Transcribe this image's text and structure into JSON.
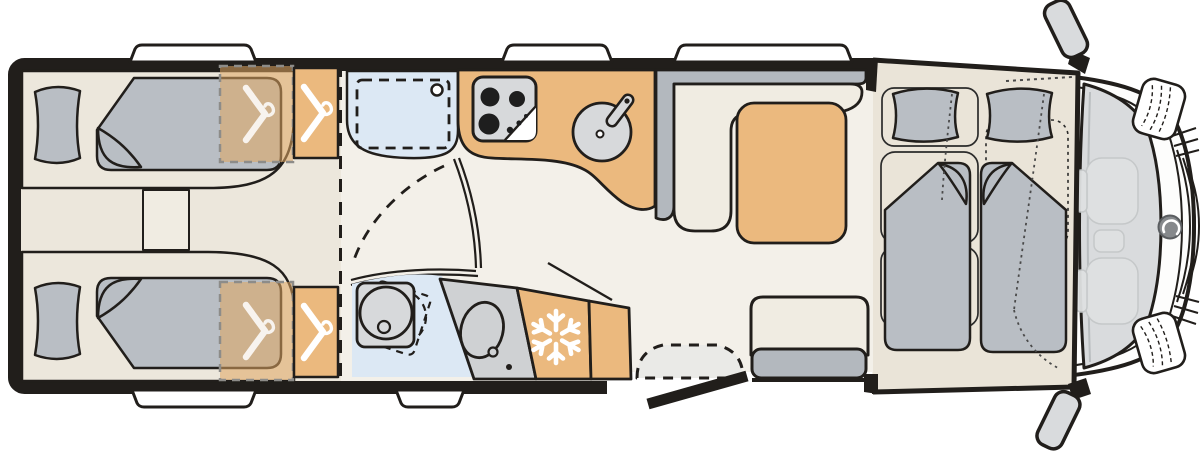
{
  "page": {
    "title": "Motorhome floor plan",
    "kind": "vehicle top-view floor plan diagram",
    "cab_position": "right"
  },
  "colors": {
    "ink": "#211e1b",
    "white": "#ffffff",
    "body": "#fdfdfc",
    "floor": "#f3f0e9",
    "bedfloor": "#ece7dc",
    "cabfloor": "#eae4d8",
    "tan": "#ebb97e",
    "tan_overlay": "#e0a660",
    "mattress": "#b9bec4",
    "uph": "#b3b8be",
    "cream": "#f0ece2",
    "blue": "#dce8f4",
    "app": "#d7d9db",
    "ghost": "#dfe1e2",
    "windshield": "#d9dbdd",
    "step": "#eaeae7",
    "dash_gray": "#8d8c89",
    "dot_gray": "#4a4a4a"
  },
  "floorplan": {
    "zones": [
      {
        "name": "rear-twin-bedroom",
        "features": [
          "single-bed-top",
          "single-bed-bottom",
          "pillows",
          "step-between-beds",
          "wardrobe-overlay-top",
          "wardrobe-top",
          "wardrobe-overlay-bottom",
          "wardrobe-bottom"
        ]
      },
      {
        "name": "washroom",
        "features": [
          "shower-cabin",
          "swivel-toilet",
          "washbasin",
          "pivoting-door"
        ]
      },
      {
        "name": "kitchen",
        "features": [
          "hob-3-burner",
          "round-sink-with-faucet",
          "refrigerator-snowflake",
          "cabinet"
        ]
      },
      {
        "name": "lounge",
        "features": [
          "l-shaped-sofa",
          "dinette-table",
          "side-bench-seat"
        ]
      },
      {
        "name": "entrance",
        "features": [
          "open-entry-door",
          "entry-step-dashed"
        ]
      },
      {
        "name": "cab",
        "features": [
          "drop-down-bed-two-mattresses",
          "ghost-driver-seat",
          "ghost-passenger-seat",
          "windshield",
          "side-mirrors",
          "headlights",
          "front-logo"
        ]
      }
    ],
    "counts": {
      "berths_rear": 2,
      "berths_cab": 2,
      "windows_top": 3,
      "windows_bottom": 2,
      "hanger_icons": 4,
      "snowflake_icons": 1
    }
  },
  "icons": [
    {
      "name": "hanger-icon",
      "meaning": "wardrobe / clothes storage"
    },
    {
      "name": "snowflake-icon",
      "meaning": "refrigerator"
    }
  ]
}
